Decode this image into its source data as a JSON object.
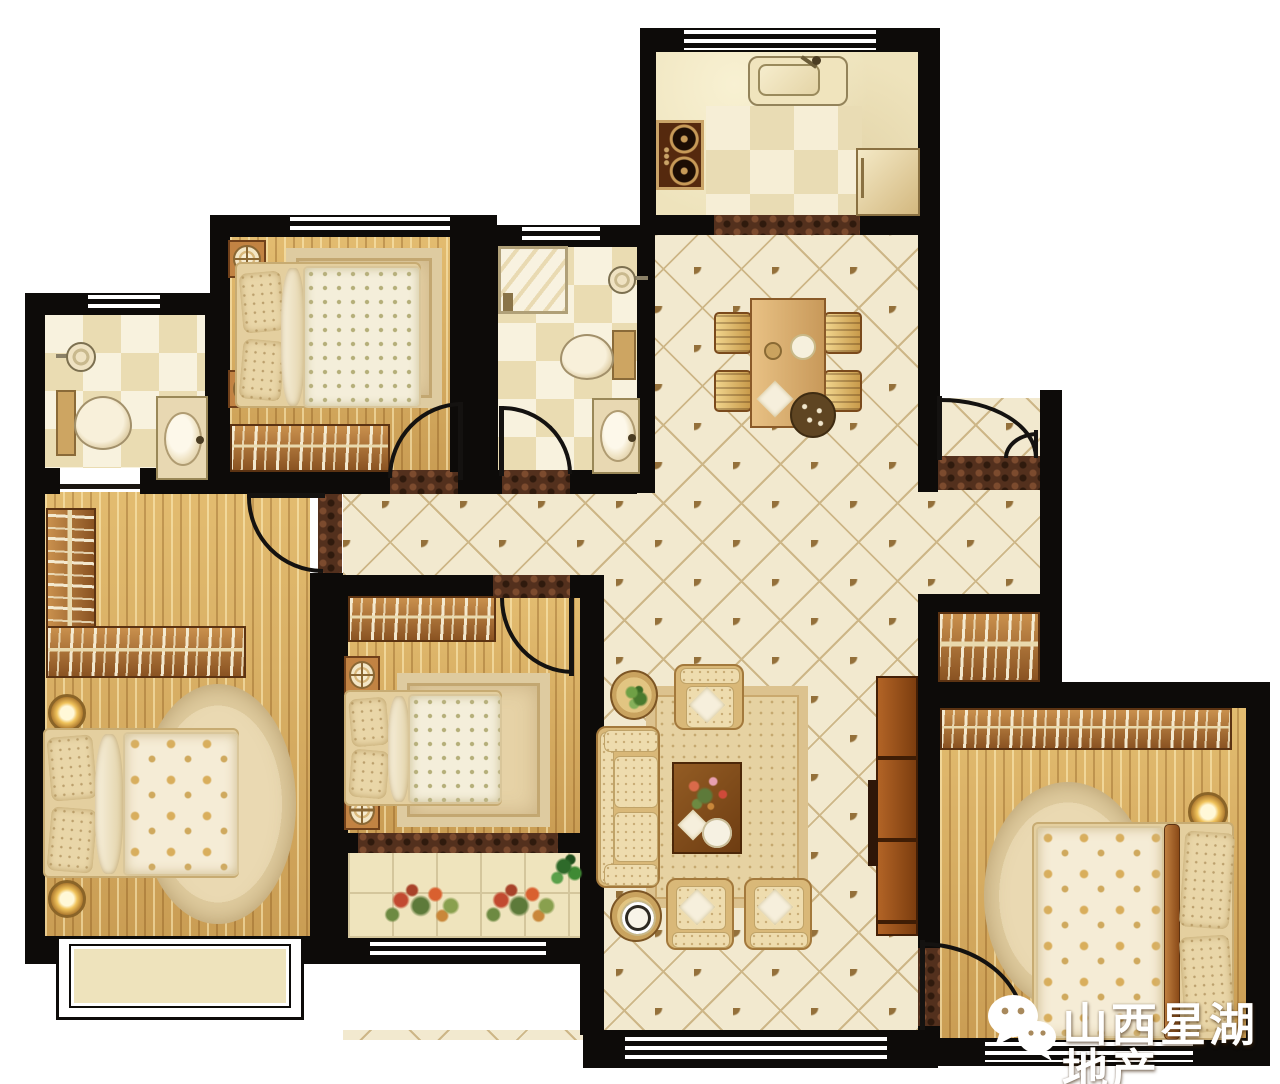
{
  "watermark": {
    "label": "山西星湖地产",
    "icon": "wechat-icon",
    "text_color": "#ffffff"
  },
  "palette": {
    "wall": "#0d0b09",
    "outside": "#ffffff",
    "wood_floor": "#d9af63",
    "hall_tile_bg": "#f2e9cf",
    "hall_tile_accent": "#94703a",
    "bath_tile_light": "#f8f2de",
    "bath_tile_dark": "#eadcb2",
    "threshold_marble": "#53301d",
    "furniture_fabric": "#eedcae",
    "furniture_wood": "#b5793a",
    "greenery": "#5d7a3a",
    "flower_red": "#c24a30"
  }
}
